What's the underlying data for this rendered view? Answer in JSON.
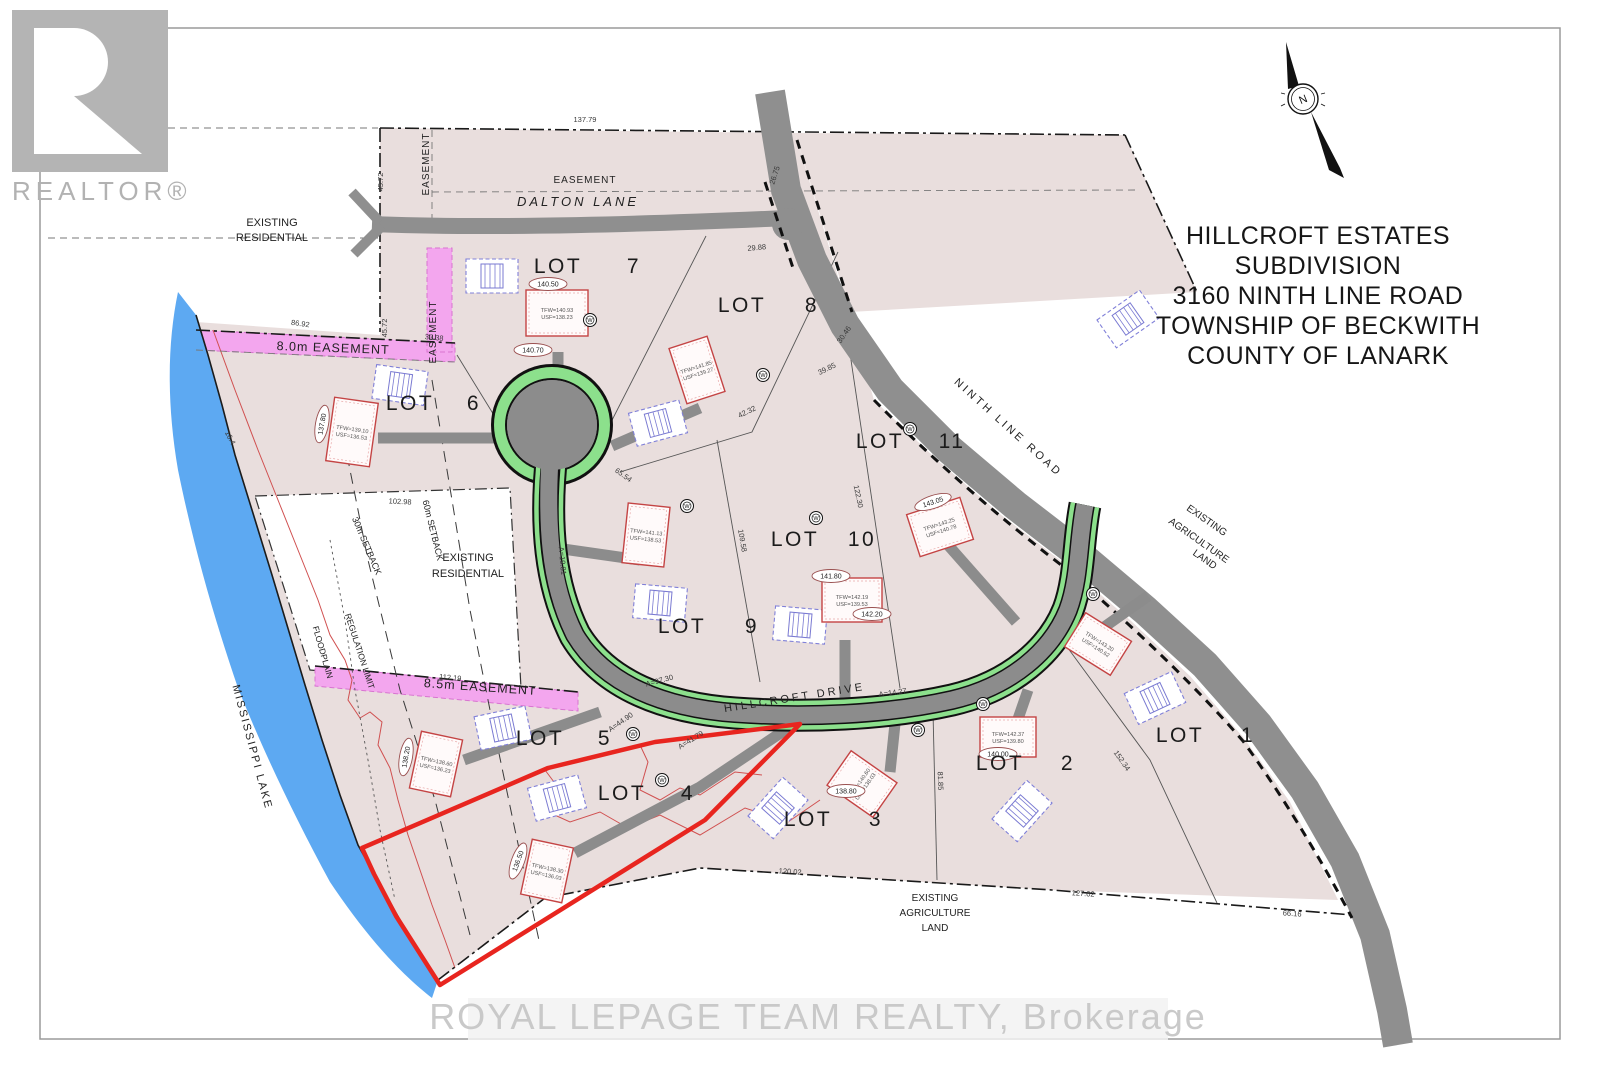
{
  "branding": {
    "realtor_label": "REALTOR®",
    "watermark": "ROYAL LEPAGE TEAM REALTY,  Brokerage"
  },
  "title_block": {
    "lines": [
      "HILLCROFT ESTATES",
      "SUBDIVISION",
      "3160 NINTH LINE ROAD",
      "TOWNSHIP OF BECKWITH",
      "COUNTY OF LANARK"
    ]
  },
  "north_arrow": {
    "label": "N"
  },
  "map": {
    "lots": [
      {
        "n": "7",
        "lx": 558,
        "nx": 634,
        "y": 273
      },
      {
        "n": "8",
        "lx": 742,
        "nx": 812,
        "y": 312
      },
      {
        "n": "6",
        "lx": 410,
        "nx": 474,
        "y": 410
      },
      {
        "n": "11",
        "lx": 880,
        "nx": 952,
        "y": 448
      },
      {
        "n": "10",
        "lx": 795,
        "nx": 862,
        "y": 546
      },
      {
        "n": "9",
        "lx": 682,
        "nx": 752,
        "y": 633
      },
      {
        "n": "5",
        "lx": 540,
        "nx": 605,
        "y": 745
      },
      {
        "n": "4",
        "lx": 622,
        "nx": 688,
        "y": 800
      },
      {
        "n": "3",
        "lx": 808,
        "nx": 876,
        "y": 826
      },
      {
        "n": "2",
        "lx": 1000,
        "nx": 1068,
        "y": 770
      },
      {
        "n": "1",
        "lx": 1180,
        "nx": 1248,
        "y": 742
      }
    ],
    "lot_word": "LOT",
    "labels": [
      [
        "DALTON LANE",
        578,
        206,
        0,
        13,
        3,
        "i"
      ],
      [
        "NINTH LINE ROAD",
        1006,
        430,
        42,
        11,
        3,
        ""
      ],
      [
        "HILLCROFT DRIVE",
        795,
        701,
        -9,
        11,
        3,
        ""
      ],
      [
        "MISSISSIPPI LAKE",
        249,
        748,
        75,
        11,
        2,
        ""
      ],
      [
        "EASEMENT",
        429,
        164,
        -90,
        10,
        1,
        ""
      ],
      [
        "EASEMENT",
        436,
        332,
        -90,
        10,
        1,
        ""
      ],
      [
        "EASEMENT",
        585,
        183,
        0,
        10,
        1,
        ""
      ],
      [
        "8.0m EASEMENT",
        333,
        352,
        2,
        12.5,
        1,
        ""
      ],
      [
        "8.5m EASEMENT",
        480,
        691,
        4,
        12.5,
        1,
        ""
      ],
      [
        "30m SETBACK",
        364,
        547,
        67,
        9,
        0,
        ""
      ],
      [
        "60m SETBACK",
        430,
        531,
        76,
        9,
        0,
        ""
      ],
      [
        "REGULATION LIMIT",
        357,
        652,
        72,
        8.5,
        0,
        ""
      ],
      [
        "FLOODPLAIN",
        320,
        653,
        74,
        8.5,
        0,
        ""
      ],
      [
        "EXISTING",
        272,
        226,
        0,
        11,
        0,
        ""
      ],
      [
        "RESIDENTIAL",
        272,
        241,
        0,
        11,
        0,
        ""
      ],
      [
        "EXISTING",
        468,
        561,
        0,
        11,
        0,
        ""
      ],
      [
        "RESIDENTIAL",
        468,
        577,
        0,
        11,
        0,
        ""
      ],
      [
        "EXISTING",
        935,
        901,
        0,
        10,
        0,
        ""
      ],
      [
        "AGRICULTURE",
        935,
        916,
        0,
        10,
        0,
        ""
      ],
      [
        "LAND",
        935,
        931,
        0,
        10,
        0,
        ""
      ],
      [
        "EXISTING",
        1205,
        523,
        35,
        10,
        0,
        ""
      ],
      [
        "AGRICULTURE",
        1197,
        543,
        35,
        10,
        0,
        ""
      ],
      [
        "LAND",
        1203,
        562,
        35,
        10,
        0,
        ""
      ]
    ],
    "dims": [
      [
        "137.79",
        585,
        122,
        0
      ],
      [
        "45.72",
        383,
        182,
        -90
      ],
      [
        "45.72",
        387,
        328,
        -90
      ],
      [
        "86.92",
        300,
        326,
        8
      ],
      [
        "33.38",
        434,
        340,
        5
      ],
      [
        "29.88",
        757,
        250,
        -5
      ],
      [
        "26.75",
        777,
        176,
        -72
      ],
      [
        "102.98",
        400,
        504,
        3
      ],
      [
        "112.19",
        450,
        680,
        5
      ],
      [
        "120.02",
        790,
        874,
        4
      ],
      [
        "127.02",
        1083,
        896,
        4
      ],
      [
        "66.16",
        1292,
        916,
        4
      ],
      [
        "152.34",
        1120,
        762,
        55
      ],
      [
        "39.85",
        828,
        371,
        -26
      ],
      [
        "30.46",
        846,
        336,
        -55
      ],
      [
        "42.32",
        748,
        414,
        -26
      ],
      [
        "65.54",
        622,
        477,
        36
      ],
      [
        "109.58",
        740,
        541,
        80
      ],
      [
        "122.30",
        856,
        497,
        78
      ],
      [
        "81.85",
        938,
        781,
        88
      ],
      [
        "16.4",
        228,
        439,
        62
      ],
      [
        "A=97.30",
        660,
        683,
        -15
      ],
      [
        "A=14.27",
        893,
        695,
        -8
      ],
      [
        "A=44.90",
        622,
        724,
        -35
      ],
      [
        "A=41.79",
        692,
        742,
        -32
      ],
      [
        "A=19.81",
        560,
        561,
        85
      ]
    ],
    "houses": [
      [
        557,
        313,
        62,
        46,
        0,
        "TFW=140.93",
        "USF=138.23"
      ],
      [
        697,
        370,
        40,
        58,
        -18,
        "TFW=141.85",
        "USF=139.27"
      ],
      [
        352,
        432,
        44,
        64,
        8,
        "TFW=139.10",
        "USF=136.53"
      ],
      [
        646,
        535,
        42,
        60,
        6,
        "TFW=141.13",
        "USF=138.53"
      ],
      [
        852,
        600,
        60,
        44,
        0,
        "TFW=142.19",
        "USF=139.53"
      ],
      [
        940,
        527,
        56,
        44,
        -18,
        "TFW=143.25",
        "USF=140.78"
      ],
      [
        1008,
        737,
        56,
        40,
        0,
        "TFW=142.37",
        "USF=139.80"
      ],
      [
        862,
        784,
        42,
        56,
        -55,
        "TFW=140.60",
        "USF=138.03"
      ],
      [
        1098,
        644,
        54,
        40,
        32,
        "TFW=143.20",
        "USF=140.62"
      ],
      [
        436,
        764,
        42,
        58,
        12,
        "TFW=138.60",
        "USF=136.23"
      ],
      [
        547,
        871,
        42,
        56,
        12,
        "TFW=138.30",
        "USF=136.03"
      ]
    ],
    "septics": [
      [
        492,
        276,
        0
      ],
      [
        400,
        385,
        8
      ],
      [
        658,
        423,
        -15
      ],
      [
        660,
        603,
        5
      ],
      [
        800,
        625,
        5
      ],
      [
        1128,
        319,
        -35
      ],
      [
        503,
        728,
        -12
      ],
      [
        557,
        798,
        -15
      ],
      [
        778,
        808,
        -48
      ],
      [
        1022,
        811,
        -48
      ],
      [
        1155,
        698,
        -25
      ]
    ],
    "wells": [
      [
        590,
        320
      ],
      [
        763,
        375
      ],
      [
        910,
        429
      ],
      [
        816,
        518
      ],
      [
        687,
        506
      ],
      [
        633,
        734
      ],
      [
        918,
        730
      ],
      [
        983,
        704
      ],
      [
        1093,
        594
      ],
      [
        662,
        780
      ]
    ],
    "well_letter": "W",
    "ovals": [
      [
        "140.50",
        548,
        284,
        0
      ],
      [
        "140.70",
        533,
        350,
        0
      ],
      [
        "143.05",
        933,
        502,
        -18
      ],
      [
        "141.80",
        831,
        576,
        0
      ],
      [
        "142.20",
        872,
        614,
        0
      ],
      [
        "137.80",
        322,
        424,
        -80
      ],
      [
        "138.20",
        406,
        757,
        -80
      ],
      [
        "136.50",
        518,
        861,
        -70
      ],
      [
        "138.80",
        846,
        791,
        0
      ],
      [
        "140.00",
        998,
        754,
        0
      ]
    ],
    "colors": {
      "parcel": "#e9dedd",
      "road": "#8f8f8f",
      "green_road": "#8ce08c",
      "lake": "#5da9f2",
      "easement": "#f3a6ee",
      "highlight_red": "#e8251f",
      "floodplain_red": "#d05050",
      "house_outline": "#c44444",
      "septic_outline": "#8080d8"
    }
  }
}
